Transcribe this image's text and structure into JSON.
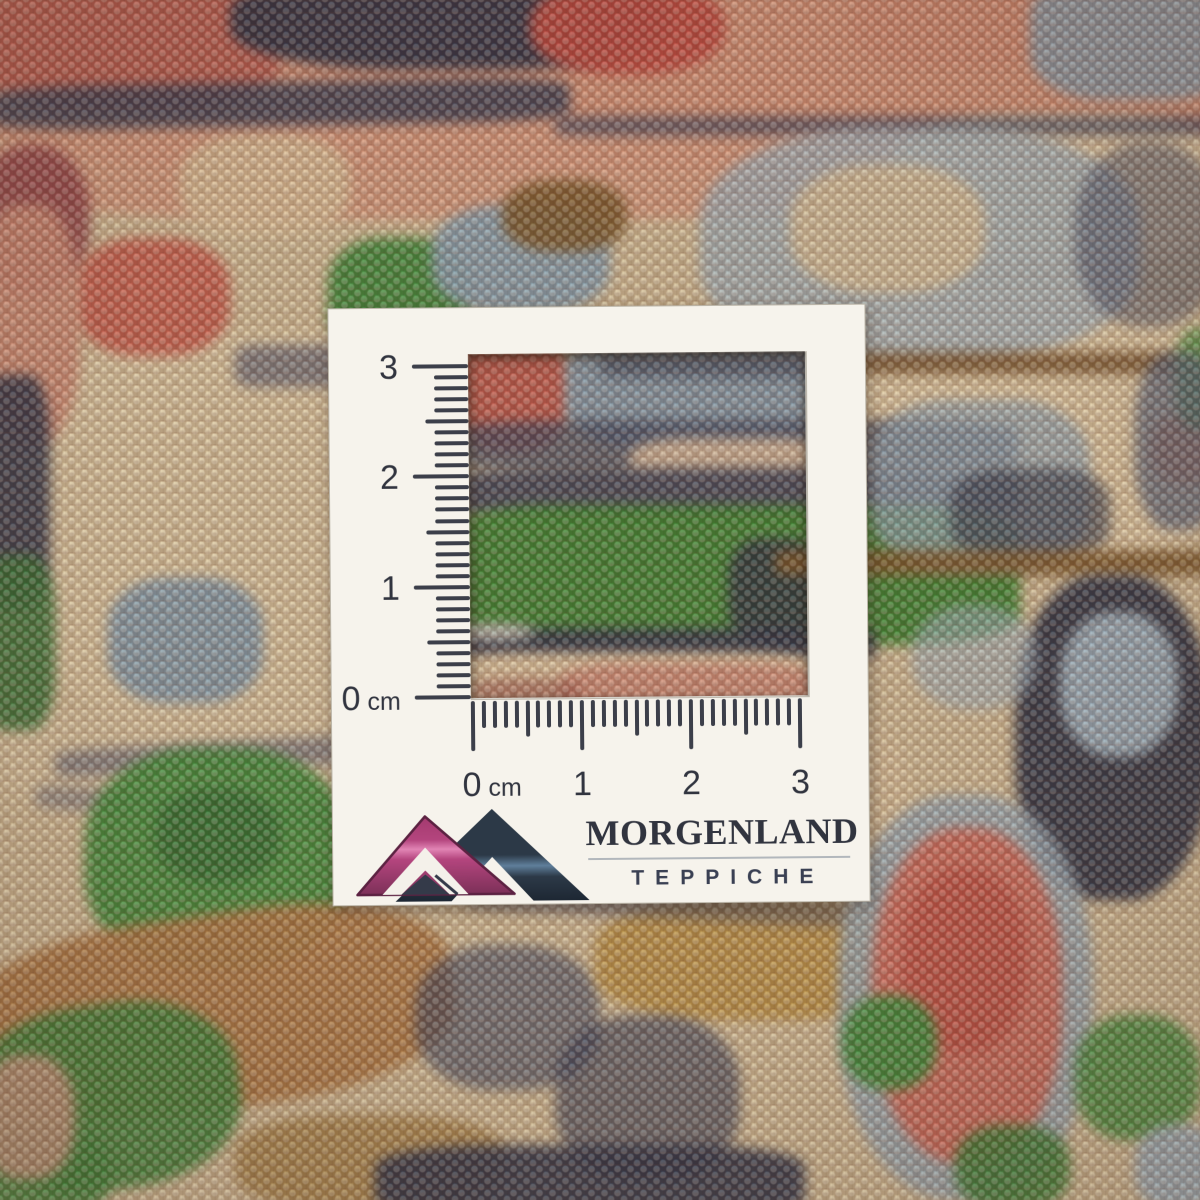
{
  "colors": {
    "card_bg": "#f6f3ec",
    "ink": "#31343f",
    "tick": "#3c3f4a",
    "divider": "#a6abb4",
    "logo": {
      "pink_top": "#a43a6f",
      "pink_mid": "#b4457e",
      "pink_bright": "#e184b4",
      "pink_deep": "#7c3058",
      "pink_outline": "#5c2242",
      "teal_dark": "#2c3947",
      "teal_deep": "#1d2733",
      "steel": "#5f7f9b",
      "inner_triangle": "#343a49",
      "white": "#f4f1ea"
    },
    "carpet_palette": {
      "beige": "#dcc9a2",
      "salmon": "#d28f74",
      "red": "#c9604f",
      "navy": "#2c3144",
      "slate_blue": "#87a1b0",
      "light_blue": "#9db3c0",
      "green": "#3d8a3a",
      "brown": "#b07c46",
      "gold": "#bb9140",
      "maroon": "#8f3f46"
    }
  },
  "card": {
    "brand": {
      "name": "MORGENLAND",
      "subtitle": "TEPPICHE"
    },
    "vertical_ruler": {
      "unit": "cm",
      "cm_labels": [
        "3",
        "2",
        "1",
        "0"
      ],
      "cm_count": 3,
      "ticks_per_cm": 10
    },
    "horizontal_ruler": {
      "unit": "cm",
      "cm_labels": [
        "0",
        "1",
        "2",
        "3"
      ],
      "cm_count": 3,
      "ticks_per_cm": 10
    }
  },
  "carpet": {
    "base": "#d3bf98",
    "patches": [
      {
        "x": -30,
        "y": -20,
        "w": 1260,
        "h": 190,
        "c": "#d28f74",
        "o": 0.95,
        "r": 25
      },
      {
        "x": -20,
        "y": 120,
        "w": 950,
        "h": 100,
        "c": "#d79a7d",
        "o": 0.9,
        "r": 35
      },
      {
        "x": 890,
        "y": 115,
        "w": 340,
        "h": 145,
        "c": "#e0cda6",
        "o": 0.95,
        "r": 35
      },
      {
        "x": 180,
        "y": 135,
        "w": 170,
        "h": 100,
        "c": "#ddc39a",
        "o": 0.9,
        "r": 40
      },
      {
        "x": 20,
        "y": 330,
        "w": 450,
        "h": 400,
        "c": "#dcc9a2",
        "o": 0.92,
        "r": 35
      },
      {
        "x": 0,
        "y": 700,
        "w": 480,
        "h": 120,
        "c": "#d9c6a0",
        "o": 0.9,
        "r": 35
      },
      {
        "x": 830,
        "y": 285,
        "w": 400,
        "h": 280,
        "c": "#dfcba4",
        "o": 0.92,
        "r": 35
      },
      {
        "x": 430,
        "y": 690,
        "w": 480,
        "h": 230,
        "c": "#d9c39c",
        "o": 0.85,
        "r": 35
      },
      {
        "x": 60,
        "y": 1150,
        "w": 260,
        "h": 70,
        "c": "#d5c09a",
        "o": 0.9,
        "r": 35
      },
      {
        "x": -20,
        "y": -25,
        "w": 300,
        "h": 135,
        "c": "#b85a4e",
        "o": 0.92,
        "r": 35
      },
      {
        "x": 230,
        "y": -30,
        "w": 440,
        "h": 100,
        "c": "#2c3144",
        "o": 0.95,
        "r": 40
      },
      {
        "x": 530,
        "y": -20,
        "w": 195,
        "h": 95,
        "c": "#c04a40",
        "o": 0.95,
        "r": 45
      },
      {
        "x": 850,
        "y": -25,
        "w": 210,
        "h": 95,
        "c": "#d08a70",
        "o": 0.9,
        "r": 40
      },
      {
        "x": 1030,
        "y": -30,
        "w": 210,
        "h": 130,
        "c": "#8c9ba6",
        "o": 0.95,
        "r": 35
      },
      {
        "x": -10,
        "y": 82,
        "w": 580,
        "h": 44,
        "c": "#323a50",
        "o": 0.85,
        "r": 20,
        "rot": -1
      },
      {
        "x": 555,
        "y": 116,
        "w": 680,
        "h": 20,
        "c": "#39415a",
        "o": 0.7,
        "r": 10
      },
      {
        "x": -25,
        "y": 145,
        "w": 115,
        "h": 150,
        "c": "#8f3f46",
        "o": 0.85,
        "r": 45
      },
      {
        "x": 75,
        "y": 238,
        "w": 155,
        "h": 118,
        "c": "#c9604f",
        "o": 0.95,
        "r": 40
      },
      {
        "x": -25,
        "y": 205,
        "w": 105,
        "h": 240,
        "c": "#d08b74",
        "o": 0.9,
        "r": 40
      },
      {
        "x": 328,
        "y": 238,
        "w": 142,
        "h": 118,
        "c": "#3d8a3a",
        "o": 0.95,
        "r": 38
      },
      {
        "x": 432,
        "y": 205,
        "w": 178,
        "h": 108,
        "c": "#87a1b0",
        "o": 0.95,
        "r": 40
      },
      {
        "x": 502,
        "y": 180,
        "w": 125,
        "h": 72,
        "c": "#7b5a2b",
        "o": 0.9,
        "r": 42
      },
      {
        "x": 700,
        "y": 128,
        "w": 440,
        "h": 232,
        "c": "#9fb2bc",
        "o": 0.8,
        "r": 40
      },
      {
        "x": 790,
        "y": 165,
        "w": 195,
        "h": 128,
        "c": "#d9c49c",
        "o": 0.9,
        "r": 42
      },
      {
        "x": 1075,
        "y": 142,
        "w": 148,
        "h": 185,
        "c": "#35405c",
        "o": 0.5,
        "r": 45
      },
      {
        "x": -20,
        "y": 375,
        "w": 70,
        "h": 235,
        "c": "#2e3447",
        "o": 0.9,
        "r": 28
      },
      {
        "x": -20,
        "y": 555,
        "w": 75,
        "h": 175,
        "c": "#357235",
        "o": 0.9,
        "r": 32
      },
      {
        "x": 108,
        "y": 578,
        "w": 155,
        "h": 125,
        "c": "#839cab",
        "o": 0.95,
        "r": 38
      },
      {
        "x": 235,
        "y": 345,
        "w": 115,
        "h": 42,
        "c": "#364063",
        "o": 0.55,
        "r": 20
      },
      {
        "x": 55,
        "y": 740,
        "w": 410,
        "h": 28,
        "c": "#3a4566",
        "o": 0.5,
        "r": 15,
        "rot": -3
      },
      {
        "x": 35,
        "y": 795,
        "w": 310,
        "h": 24,
        "c": "#3a4566",
        "o": 0.4,
        "r": 15,
        "rot": 4
      },
      {
        "x": 452,
        "y": 332,
        "w": 118,
        "h": 120,
        "c": "#bf574b",
        "o": 0.95,
        "r": 38
      },
      {
        "x": 565,
        "y": 328,
        "w": 290,
        "h": 122,
        "c": "#8097a8",
        "o": 0.95,
        "r": 32
      },
      {
        "x": 600,
        "y": 352,
        "w": 250,
        "h": 26,
        "c": "#333d52",
        "o": 0.6,
        "r": 12
      },
      {
        "x": 448,
        "y": 420,
        "w": 570,
        "h": 52,
        "c": "#3a445c",
        "o": 0.75,
        "r": 22
      },
      {
        "x": 630,
        "y": 438,
        "w": 205,
        "h": 56,
        "c": "#dcc0a0",
        "o": 0.9,
        "r": 30
      },
      {
        "x": 445,
        "y": 468,
        "w": 575,
        "h": 52,
        "c": "#2f3850",
        "o": 0.85,
        "r": 22
      },
      {
        "x": 440,
        "y": 505,
        "w": 580,
        "h": 140,
        "c": "#39842f",
        "o": 0.95,
        "r": 20
      },
      {
        "x": 728,
        "y": 538,
        "w": 92,
        "h": 106,
        "c": "#2a3340",
        "o": 0.85,
        "r": 35
      },
      {
        "x": 445,
        "y": 628,
        "w": 430,
        "h": 32,
        "c": "#2c3347",
        "o": 0.9,
        "r": 14
      },
      {
        "x": 455,
        "y": 624,
        "w": 80,
        "h": 16,
        "c": "#e9e5d9",
        "o": 0.8,
        "r": 50
      },
      {
        "x": 450,
        "y": 653,
        "w": 370,
        "h": 58,
        "c": "#e0c9a2",
        "o": 0.95,
        "r": 22
      },
      {
        "x": 560,
        "y": 663,
        "w": 260,
        "h": 52,
        "c": "#cf8a75",
        "o": 0.9,
        "r": 28
      },
      {
        "x": 470,
        "y": 678,
        "w": 110,
        "h": 26,
        "c": "#9a5248",
        "o": 0.6,
        "r": 40
      },
      {
        "x": 850,
        "y": 352,
        "w": 330,
        "h": 22,
        "c": "#6e4a22",
        "o": 0.8,
        "r": 10
      },
      {
        "x": 870,
        "y": 400,
        "w": 220,
        "h": 170,
        "c": "#8da4b2",
        "o": 0.75,
        "r": 35
      },
      {
        "x": 950,
        "y": 468,
        "w": 160,
        "h": 92,
        "c": "#2e3748",
        "o": 0.65,
        "r": 35
      },
      {
        "x": 1150,
        "y": 413,
        "w": 70,
        "h": 72,
        "c": "#d08158",
        "o": 0.85,
        "r": 45
      },
      {
        "x": 1175,
        "y": 328,
        "w": 48,
        "h": 102,
        "c": "#3f8c3b",
        "o": 0.75,
        "r": 40
      },
      {
        "x": 1135,
        "y": 352,
        "w": 88,
        "h": 178,
        "c": "#4b5a74",
        "o": 0.7,
        "r": 40
      },
      {
        "x": 775,
        "y": 550,
        "w": 445,
        "h": 26,
        "c": "#7d5a2b",
        "o": 0.9,
        "r": 12
      },
      {
        "x": 1015,
        "y": 575,
        "w": 195,
        "h": 325,
        "c": "#2d3445",
        "o": 0.95,
        "r": 42
      },
      {
        "x": 1060,
        "y": 612,
        "w": 118,
        "h": 145,
        "c": "#9db3c0",
        "o": 0.95,
        "r": 45
      },
      {
        "x": 912,
        "y": 605,
        "w": 125,
        "h": 105,
        "c": "#9db3c0",
        "o": 0.6,
        "r": 45
      },
      {
        "x": 85,
        "y": 748,
        "w": 265,
        "h": 222,
        "c": "#3f8d3a",
        "o": 0.95,
        "r": 42
      },
      {
        "x": 155,
        "y": 788,
        "w": 125,
        "h": 95,
        "c": "#2c6b2f",
        "o": 0.7,
        "r": 45
      },
      {
        "x": -35,
        "y": 915,
        "w": 490,
        "h": 195,
        "c": "#b07c46",
        "o": 0.95,
        "r": 38,
        "rot": -8
      },
      {
        "x": -30,
        "y": 1005,
        "w": 270,
        "h": 185,
        "c": "#3b8438",
        "o": 0.9,
        "r": 42,
        "rot": -8
      },
      {
        "x": 235,
        "y": 1115,
        "w": 270,
        "h": 95,
        "c": "#a8854a",
        "o": 0.85,
        "r": 38
      },
      {
        "x": 415,
        "y": 945,
        "w": 185,
        "h": 145,
        "c": "#33405e",
        "o": 0.6,
        "r": 42
      },
      {
        "x": 595,
        "y": 900,
        "w": 310,
        "h": 120,
        "c": "#bb9140",
        "o": 0.85,
        "r": 38
      },
      {
        "x": 555,
        "y": 1015,
        "w": 185,
        "h": 165,
        "c": "#333c55",
        "o": 0.65,
        "r": 42
      },
      {
        "x": 465,
        "y": 893,
        "w": 390,
        "h": 26,
        "c": "#3a4566",
        "o": 0.45,
        "r": 14,
        "rot": 3
      },
      {
        "x": 838,
        "y": 795,
        "w": 255,
        "h": 405,
        "c": "#95a9b5",
        "o": 0.85,
        "r": 45
      },
      {
        "x": 872,
        "y": 828,
        "w": 190,
        "h": 335,
        "c": "#cf6c5c",
        "o": 0.97,
        "r": 45
      },
      {
        "x": 902,
        "y": 868,
        "w": 125,
        "h": 185,
        "c": "#c05346",
        "o": 0.9,
        "r": 45
      },
      {
        "x": 842,
        "y": 995,
        "w": 95,
        "h": 95,
        "c": "#3f8c3b",
        "o": 0.97,
        "r": 45
      },
      {
        "x": 955,
        "y": 1125,
        "w": 115,
        "h": 85,
        "c": "#3b7f36",
        "o": 0.9,
        "r": 42
      },
      {
        "x": 1075,
        "y": 1015,
        "w": 125,
        "h": 125,
        "c": "#3f8c3b",
        "o": 0.85,
        "r": 42
      },
      {
        "x": 1135,
        "y": 1125,
        "w": 85,
        "h": 85,
        "c": "#9db3c0",
        "o": 0.9,
        "r": 42
      },
      {
        "x": 375,
        "y": 1145,
        "w": 430,
        "h": 75,
        "c": "#2c3449",
        "o": 0.9,
        "r": 28
      },
      {
        "x": -25,
        "y": 1125,
        "w": 135,
        "h": 95,
        "c": "#3b8438",
        "o": 0.85,
        "r": 42
      },
      {
        "x": -20,
        "y": 1055,
        "w": 95,
        "h": 125,
        "c": "#d29a84",
        "o": 0.8,
        "r": 42
      }
    ]
  }
}
